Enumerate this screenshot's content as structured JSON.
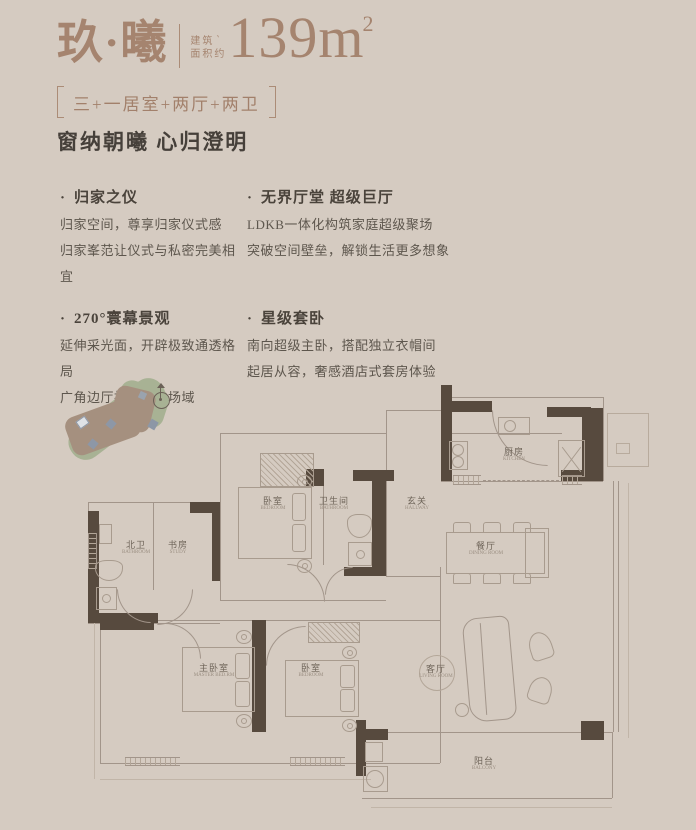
{
  "header": {
    "title": "玖·曦",
    "area_label_line1": "建筑",
    "area_label_line2": "面积约",
    "tick": "`",
    "area_value": "139m",
    "area_sup": "2",
    "subtitle": "三+一居室+两厅+两卫",
    "tagline": "窗纳朝曦 心归澄明"
  },
  "bullet": "·",
  "features": [
    {
      "title": "归家之仪",
      "lines": [
        "归家空间，尊享归家仪式感",
        "归家峯范让仪式与私密完美相宜"
      ]
    },
    {
      "title": "无界厅堂 超级巨厅",
      "lines": [
        "LDKB一体化构筑家庭超级聚场",
        "突破空间壁垒，解锁生活更多想象"
      ]
    },
    {
      "title": "270°寰幕景观",
      "lines": [
        "延伸采光面，开辟极致通透格局",
        "广角边厅拓展光的场域"
      ]
    },
    {
      "title": "星级套卧",
      "lines": [
        "南向超级主卧，搭配独立衣帽间",
        "起居从容，奢感酒店式套房体验"
      ]
    }
  ],
  "rooms": {
    "kitchen": {
      "name": "厨房",
      "en": "KITCHEN"
    },
    "hallway": {
      "name": "玄关",
      "en": "HALLWAY"
    },
    "bedroom_top": {
      "name": "卧室",
      "en": "BEDROOM"
    },
    "bathroom": {
      "name": "卫生间",
      "en": "BATHROOM"
    },
    "north_bath": {
      "name": "北卫",
      "en": "BATHROOM"
    },
    "study": {
      "name": "书房",
      "en": "STUDY"
    },
    "master": {
      "name": "主卧室",
      "en": "MASTER BED.RM"
    },
    "bedroom2": {
      "name": "卧室",
      "en": "BEDROOM"
    },
    "dining": {
      "name": "餐厅",
      "en": "DINING ROOM"
    },
    "living": {
      "name": "客厅",
      "en": "LIVING ROOM"
    },
    "balcony": {
      "name": "阳台",
      "en": "BALCONY"
    }
  },
  "colors": {
    "background": "#d5cbc1",
    "accent_brown": "#a5846f",
    "dark_text": "#46403a",
    "body_text": "#5d564d",
    "wall_dark": "#574a3e",
    "wall_line": "#a2958a",
    "site_green": "#a8b294",
    "site_brown": "#a5907f",
    "marker_blue": "#8d97a6"
  }
}
